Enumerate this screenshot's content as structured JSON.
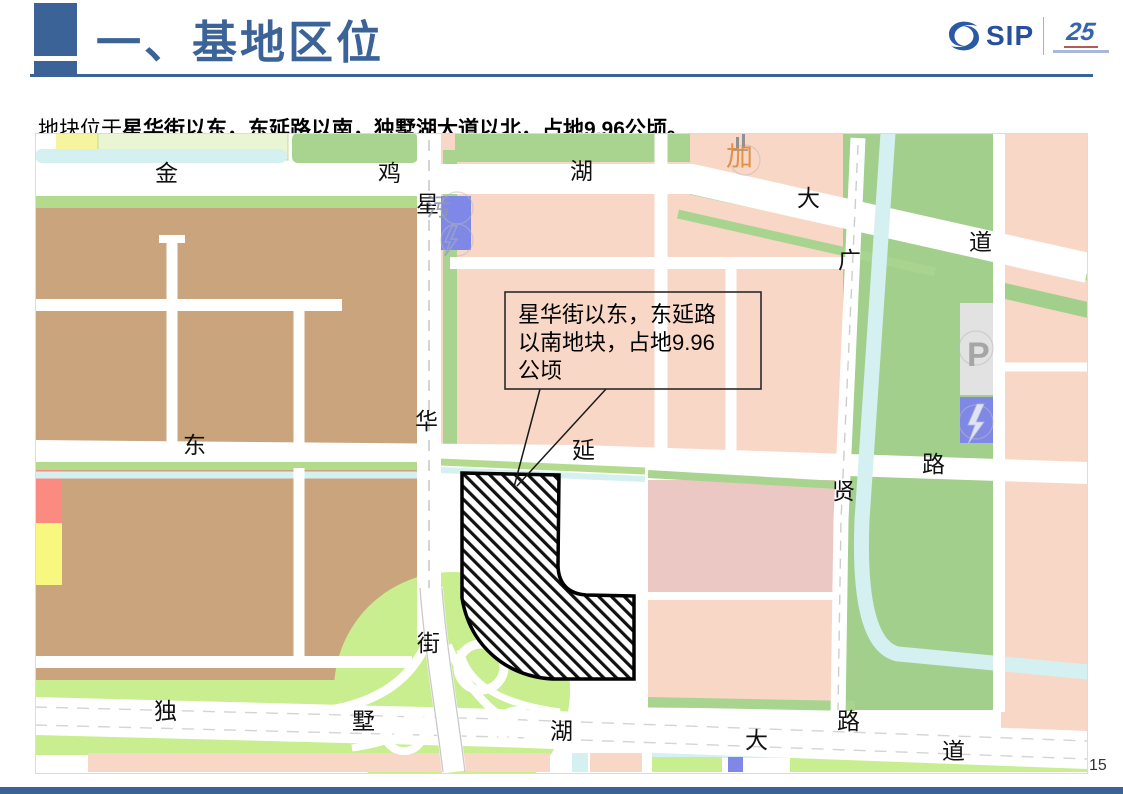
{
  "slide": {
    "title": "一、基地区位",
    "subtitle_prefix": "地块位于",
    "subtitle_emphasis": "星华街以东，东延路以南，独墅湖大道以北，占地9.96公顷。",
    "page_number": "15"
  },
  "logo": {
    "name": "SIP",
    "anniversary": "25"
  },
  "map": {
    "callout": {
      "lines": [
        "星华街以东，东延路",
        "以南地块，占地9.96",
        "公顷"
      ]
    },
    "road_labels": [
      {
        "t": "金",
        "x": 155,
        "y": 181
      },
      {
        "t": "鸡",
        "x": 378,
        "y": 181
      },
      {
        "t": "湖",
        "x": 570,
        "y": 179
      },
      {
        "t": "星",
        "x": 416,
        "y": 212
      },
      {
        "t": "大",
        "x": 797,
        "y": 206
      },
      {
        "t": "广",
        "x": 838,
        "y": 268
      },
      {
        "t": "道",
        "x": 969,
        "y": 250
      },
      {
        "t": "东",
        "x": 183,
        "y": 453
      },
      {
        "t": "华",
        "x": 415,
        "y": 429
      },
      {
        "t": "延",
        "x": 572,
        "y": 458
      },
      {
        "t": "路",
        "x": 922,
        "y": 472
      },
      {
        "t": "贤",
        "x": 832,
        "y": 499
      },
      {
        "t": "街",
        "x": 417,
        "y": 651
      },
      {
        "t": "独",
        "x": 154,
        "y": 719
      },
      {
        "t": "墅",
        "x": 352,
        "y": 729
      },
      {
        "t": "湖",
        "x": 550,
        "y": 739
      },
      {
        "t": "大",
        "x": 745,
        "y": 748
      },
      {
        "t": "路",
        "x": 837,
        "y": 729
      },
      {
        "t": "道",
        "x": 942,
        "y": 759
      }
    ],
    "poi_labels": [
      {
        "t": "加",
        "x": 726,
        "y": 166,
        "c": "#e08a3c",
        "s": 27,
        "o": 0.9
      },
      {
        "t": "污",
        "x": 426,
        "y": 216,
        "c": "#8e98a8",
        "s": 25,
        "o": 0.85
      },
      {
        "t": "P",
        "x": 967,
        "y": 366,
        "c": "#a6a6a6",
        "s": 34,
        "b": true,
        "o": 1
      }
    ],
    "colors": {
      "accent_blue": "#3b6398",
      "road_white": "#ffffff",
      "parcel_pink": "#f9d7c7",
      "parcel_mauve": "#ebc8c4",
      "parcel_tan": "#caa47d",
      "parcel_green": "#a2cf8c",
      "green_strip": "#a9d48f",
      "green_bright": "#c8ee90",
      "water_cyan": "#d4f0f1",
      "parcel_blue": "#7f88e6",
      "parcel_gray": "#e2e2e2",
      "parcel_red": "#fb8a80",
      "parcel_yellow": "#f8f77f",
      "site_hatch": "#111111"
    }
  }
}
